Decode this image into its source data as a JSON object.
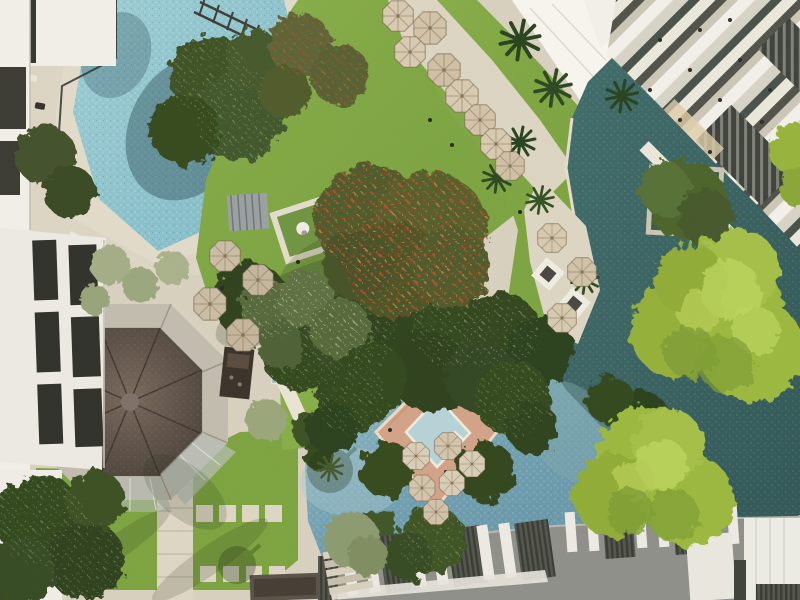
{
  "meta": {
    "type": "aerial-photograph",
    "view": "top-down drone view",
    "subject": "tropical resort courtyard with swimming pools, lawns, a flame tree, an octagonal bar pavilion, lagoon channels, bamboo groves and white low-rise hotel wings"
  },
  "colors": {
    "paving": "#d9d0be",
    "paving_light": "#e7e0cf",
    "pool_top": "#8fc4cd",
    "lagoon": "#3a6563",
    "lower_pool": "#76a4b4",
    "jacuzzi": "#b6d2d8",
    "lawn": "#7ca33f",
    "lawn_light": "#93b553",
    "foliage_dark": "#31451f",
    "foliage_mid": "#4a6128",
    "bamboo": "#9cb83e",
    "bamboo_light": "#bcd45c",
    "flame_canopy": "#4e5a2a",
    "flame_red": "#c14f2c",
    "flame_orange": "#d97b3f",
    "building_white": "#f1efe8",
    "window_dark": "#35352f",
    "roof_gray": "#8f8f89",
    "fin_white": "#eceae3",
    "slat_dark": "#474941",
    "pavilion_roof": "#5f524a",
    "pavilion_ring": "#c2bcae",
    "glass_apron": "#b8bdb6",
    "umbrella": "#d8cab1",
    "canopy_white": "#f7f5ee",
    "deck_salmon": "#d2a286",
    "palm_sage": "#a3ad85",
    "statue_white": "#efece3",
    "shadow": "#1f2d13",
    "water_sparkle": "#eaf5f5"
  },
  "scene": {
    "regions": [
      {
        "id": "top-left-pool",
        "label": "main swimming pool",
        "description": "angular turquoise mosaic pool beside the west hotel wing, trees overhanging"
      },
      {
        "id": "left-building",
        "label": "west hotel wing",
        "description": "white facade with dark glazed window strips and a sun deck with loungers"
      },
      {
        "id": "main-lawn",
        "label": "central lawn",
        "description": "large manicured grass courtyard"
      },
      {
        "id": "flame-tree",
        "label": "flame tree",
        "description": "large canopy dotted with red-orange blossoms at the centre of the lawn"
      },
      {
        "id": "statue-garden",
        "label": "statue garden",
        "description": "small framed planting square with a white sculpture"
      },
      {
        "id": "bar-pavilion",
        "label": "octagonal bar pavilion",
        "description": "dark shingled octagonal roof with concrete eave ring and glass apron"
      },
      {
        "id": "upper-terrace",
        "label": "umbrella terrace",
        "description": "diagonal stone terrace with rows of beige parasols"
      },
      {
        "id": "white-canopy",
        "label": "white canopy",
        "description": "bright diagonal fabric roof between lawn and east wing"
      },
      {
        "id": "right-building",
        "label": "east hotel wing",
        "description": "white 45-degree roof beams, balconies and dark louvred skylights"
      },
      {
        "id": "lagoon",
        "label": "lagoon channel",
        "description": "deep teal water wrapping the east wing with a planted island"
      },
      {
        "id": "cabana-terrace",
        "label": "cabana terrace",
        "description": "daybed cabanas and parasols on the lagoon bank"
      },
      {
        "id": "bamboo-groves",
        "label": "bamboo groves",
        "description": "two bright chartreuse bamboo canopies over the water"
      },
      {
        "id": "main-pool",
        "label": "lower lagoon pool",
        "description": "large free-form pool with diamond swim-up deck"
      },
      {
        "id": "swim-up-deck",
        "label": "diamond deck",
        "description": "salmon paved island deck with plunge pool, parasols and corner trees"
      },
      {
        "id": "rooftop-band",
        "label": "south rooftops",
        "description": "grey roof with white walkway fins and dark louvred slabs"
      },
      {
        "id": "lower-lawn",
        "label": "south-west lawn",
        "description": "lawn with stepping-stone paths and palm shadows"
      }
    ]
  }
}
